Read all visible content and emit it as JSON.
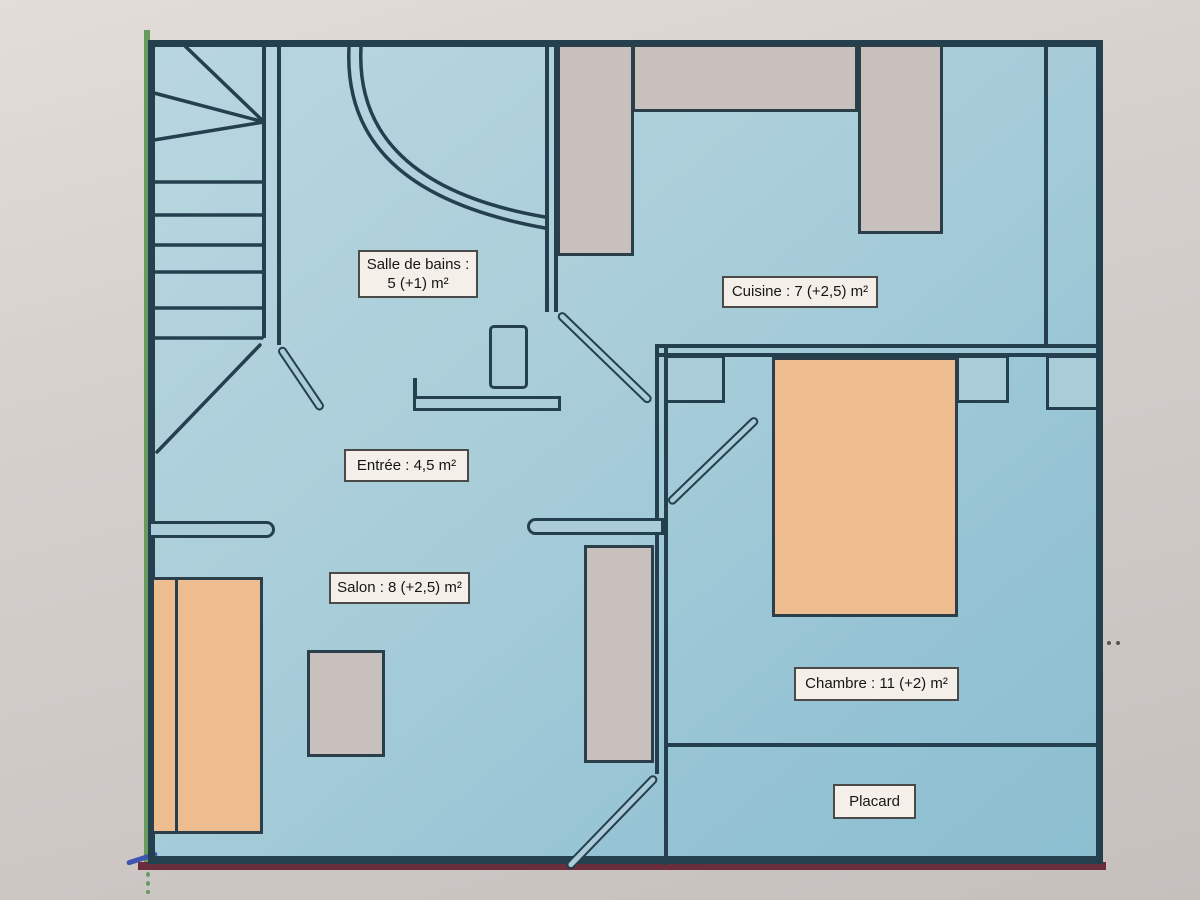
{
  "plan": {
    "rooms": {
      "salle_de_bains": {
        "name_line": "Salle de bains :",
        "area_line": "5 (+1) m²"
      },
      "cuisine": {
        "label": "Cuisine : 7 (+2,5) m²"
      },
      "entree": {
        "label": "Entrée : 4,5 m²"
      },
      "salon": {
        "label": "Salon : 8 (+2,5) m²"
      },
      "chambre": {
        "label": "Chambre : 11 (+2) m²"
      },
      "placard": {
        "label": "Placard"
      }
    },
    "colors": {
      "wall": "#243f4e",
      "floor-a": "#b9d6e0",
      "floor-b": "#a8cdd9",
      "floor-c": "#8cbfd1",
      "floor2": "#aaccd8",
      "gray": "#c7c0bc",
      "orange": "#edbd90",
      "labelbg": "#f4efe8",
      "green": "#68995f",
      "maroon": "#6b2c3c",
      "photo-a": "#e2ddd8",
      "photo-b": "#d6d0cd",
      "photo-c": "#c6c0bd"
    }
  }
}
